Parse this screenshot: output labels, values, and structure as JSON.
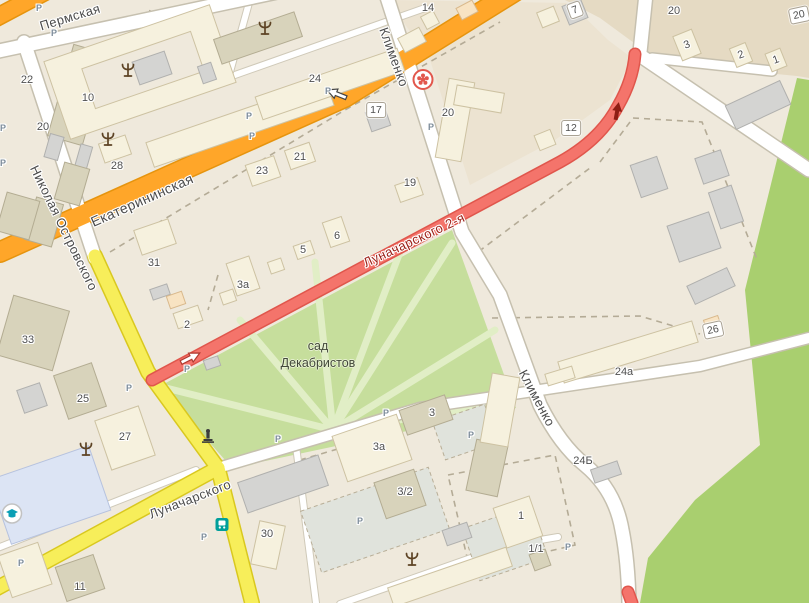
{
  "map": {
    "park_label": {
      "line1": "сад",
      "line2": "Декабристов",
      "x": 318,
      "y": 355
    },
    "street_labels": [
      {
        "text": "Пермская",
        "x": 70,
        "y": 17,
        "rot": -17,
        "size": 13
      },
      {
        "text": "Николая Островского",
        "x": 64,
        "y": 228,
        "rot": 64,
        "size": 13
      },
      {
        "text": "Екатерининская",
        "x": 142,
        "y": 200,
        "rot": -24,
        "size": 14
      },
      {
        "text": "Клименко",
        "x": 394,
        "y": 57,
        "rot": 70,
        "size": 13
      },
      {
        "text": "Клименко",
        "x": 537,
        "y": 398,
        "rot": 62,
        "size": 13
      },
      {
        "text": "Луначарского 2-я",
        "x": 414,
        "y": 240,
        "rot": -25,
        "size": 13,
        "color": "#9c2018"
      },
      {
        "text": "Луначарского",
        "x": 190,
        "y": 499,
        "rot": -21,
        "size": 13
      }
    ],
    "house_labels": [
      {
        "text": "22",
        "x": 27,
        "y": 80
      },
      {
        "text": "10",
        "x": 88,
        "y": 98
      },
      {
        "text": "20",
        "x": 43,
        "y": 127
      },
      {
        "text": "28",
        "x": 117,
        "y": 166
      },
      {
        "text": "24",
        "x": 315,
        "y": 79
      },
      {
        "text": "23",
        "x": 262,
        "y": 171
      },
      {
        "text": "21",
        "x": 300,
        "y": 157
      },
      {
        "text": "19",
        "x": 410,
        "y": 183
      },
      {
        "text": "20",
        "x": 448,
        "y": 113
      },
      {
        "text": "14",
        "x": 428,
        "y": 8
      },
      {
        "text": "20",
        "x": 674,
        "y": 11
      },
      {
        "text": "3",
        "x": 687,
        "y": 45,
        "rot": -20
      },
      {
        "text": "2",
        "x": 741,
        "y": 55,
        "rot": -20
      },
      {
        "text": "1",
        "x": 776,
        "y": 60,
        "rot": -20
      },
      {
        "text": "31",
        "x": 154,
        "y": 263
      },
      {
        "text": "3а",
        "x": 243,
        "y": 285
      },
      {
        "text": "2",
        "x": 187,
        "y": 325
      },
      {
        "text": "5",
        "x": 303,
        "y": 250
      },
      {
        "text": "6",
        "x": 337,
        "y": 236
      },
      {
        "text": "33",
        "x": 28,
        "y": 340
      },
      {
        "text": "25",
        "x": 83,
        "y": 399
      },
      {
        "text": "27",
        "x": 125,
        "y": 437
      },
      {
        "text": "30",
        "x": 267,
        "y": 534
      },
      {
        "text": "3а",
        "x": 379,
        "y": 447
      },
      {
        "text": "3",
        "x": 432,
        "y": 413
      },
      {
        "text": "3/2",
        "x": 405,
        "y": 492
      },
      {
        "text": "1",
        "x": 521,
        "y": 516
      },
      {
        "text": "1/1",
        "x": 536,
        "y": 549
      },
      {
        "text": "11",
        "x": 80,
        "y": 587
      },
      {
        "text": "24а",
        "x": 624,
        "y": 372
      },
      {
        "text": "24Б",
        "x": 583,
        "y": 461
      }
    ],
    "address_badges": [
      {
        "text": "7",
        "x": 575,
        "y": 10,
        "rot": -20
      },
      {
        "text": "20",
        "x": 799,
        "y": 15,
        "rot": -12
      },
      {
        "text": "12",
        "x": 571,
        "y": 128,
        "rot": 0
      },
      {
        "text": "17",
        "x": 376,
        "y": 110,
        "rot": 0
      },
      {
        "text": "26",
        "x": 713,
        "y": 330,
        "rot": -12
      }
    ],
    "parking_marks": [
      {
        "x": 39,
        "y": 8
      },
      {
        "x": 54,
        "y": 33
      },
      {
        "x": 3,
        "y": 128
      },
      {
        "x": 3,
        "y": 163
      },
      {
        "x": 249,
        "y": 116
      },
      {
        "x": 252,
        "y": 136
      },
      {
        "x": 328,
        "y": 91
      },
      {
        "x": 431,
        "y": 127
      },
      {
        "x": 187,
        "y": 369
      },
      {
        "x": 129,
        "y": 388
      },
      {
        "x": 278,
        "y": 439
      },
      {
        "x": 386,
        "y": 413
      },
      {
        "x": 471,
        "y": 435
      },
      {
        "x": 360,
        "y": 521
      },
      {
        "x": 204,
        "y": 537
      },
      {
        "x": 568,
        "y": 547
      },
      {
        "x": 21,
        "y": 563
      }
    ],
    "pois": [
      {
        "icon": "pharmacy-icon",
        "x": 423,
        "y": 82
      },
      {
        "icon": "bus-stop-icon",
        "x": 222,
        "y": 527
      },
      {
        "icon": "education-icon",
        "x": 12,
        "y": 516
      },
      {
        "icon": "monument-icon",
        "x": 208,
        "y": 438
      },
      {
        "icon": "tree-icon",
        "x": 128,
        "y": 72
      },
      {
        "icon": "tree-icon",
        "x": 265,
        "y": 30
      },
      {
        "icon": "tree-icon",
        "x": 108,
        "y": 141
      },
      {
        "icon": "tree-icon",
        "x": 86,
        "y": 451
      },
      {
        "icon": "tree-icon",
        "x": 412,
        "y": 561
      }
    ],
    "colors": {
      "background": "#efe9dc",
      "block_tan": "#e5dac3",
      "block_midtan": "#ece3d1",
      "park_green": "#c6de9c",
      "park_path": "#e1eec6",
      "greenery": "#a9cf6f",
      "road_main": "#ffa629",
      "road_secondary": "#f7ee5a",
      "road_closed": "#f4746b",
      "road_white": "#ffffff",
      "street_text": "#4b4b4b",
      "closed_text": "#9c2018"
    }
  }
}
